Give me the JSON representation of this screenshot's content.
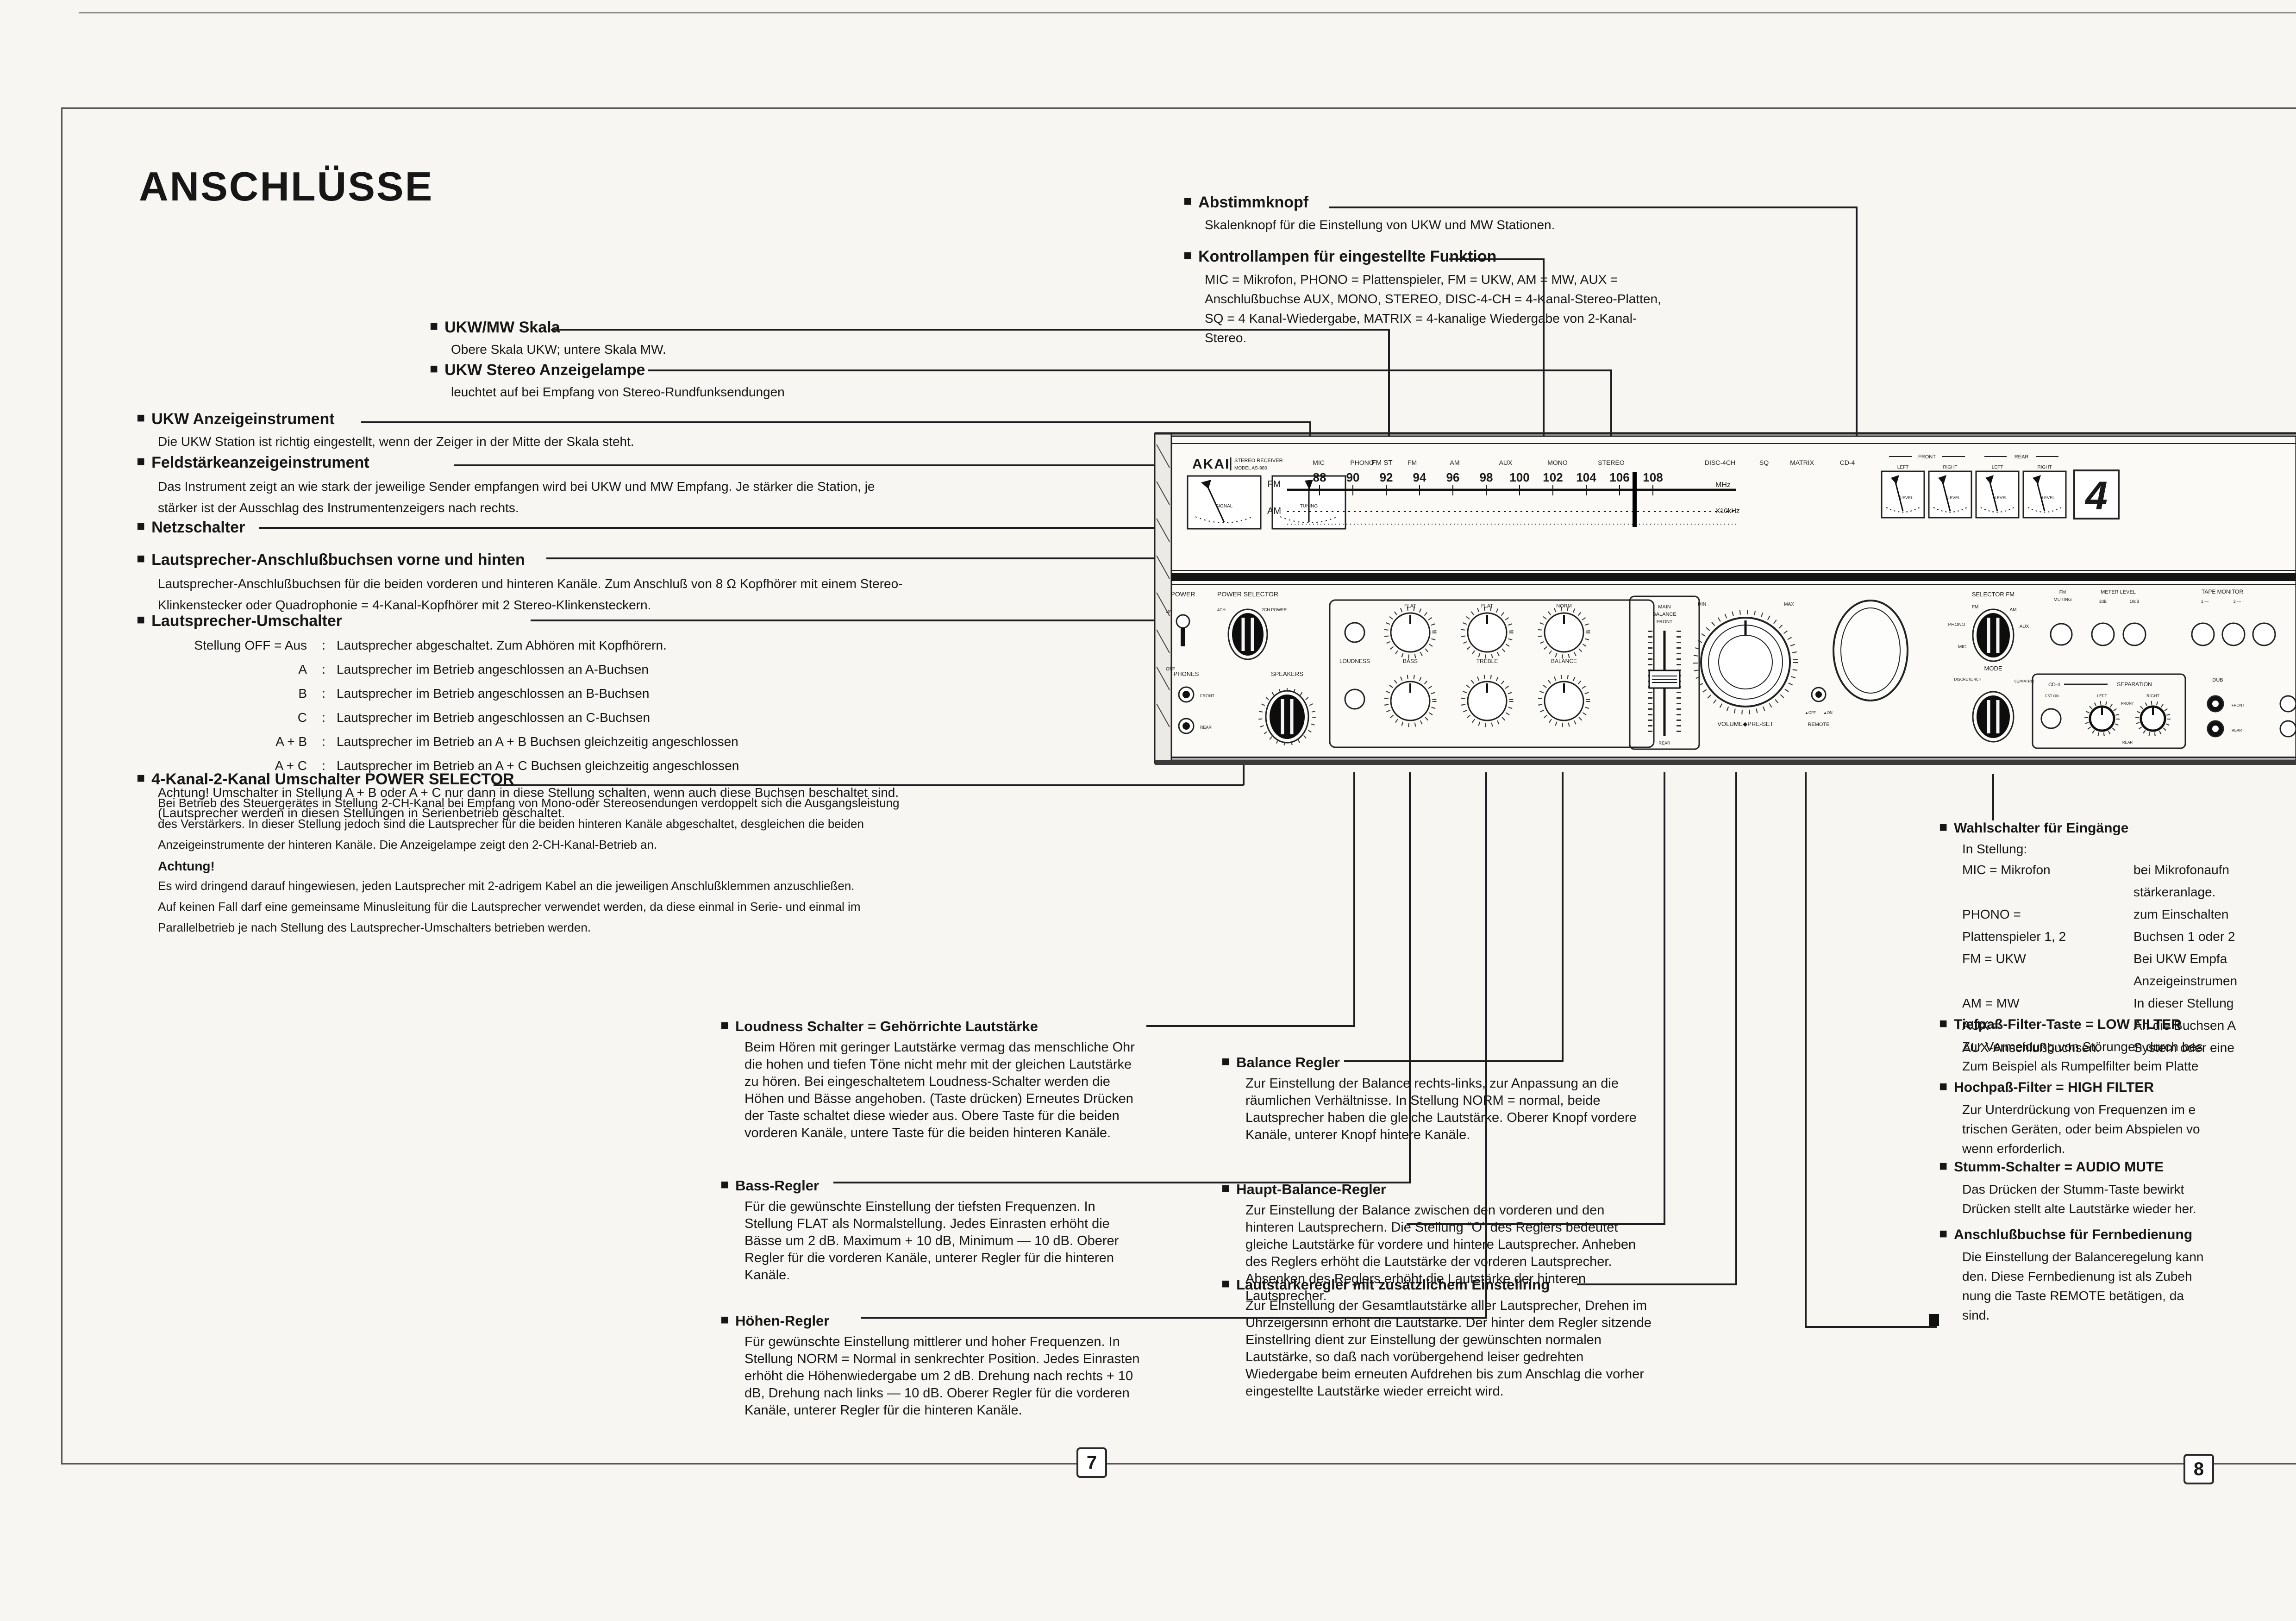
{
  "page": {
    "title": "ANSCHLÜSSE",
    "bullet": "■",
    "page_number_left": "7",
    "page_number_right": "8"
  },
  "annotations": {
    "abstimmknopf": {
      "heading": "Abstimmknopf",
      "body": "Skalenknopf für die Einstellung von UKW und MW Stationen."
    },
    "kontrollampen": {
      "heading": "Kontrollampen für eingestellte Funktion",
      "body": "MIC = Mikrofon, PHONO = Plattenspieler, FM = UKW, AM = MW, AUX = Anschlußbuchse AUX, MONO, STEREO, DISC-4-CH = 4-Kanal-Stereo-Platten, SQ = 4 Kanal-Wiedergabe, MATRIX = 4-kanalige Wiedergabe von 2-Kanal-Stereo."
    },
    "ukw_mw_skala": {
      "heading": "UKW/MW Skala",
      "body": "Obere Skala UKW; untere Skala MW."
    },
    "ukw_stereo_lampe": {
      "heading": "UKW Stereo Anzeigelampe",
      "body": "leuchtet auf bei Empfang von Stereo-Rundfunksendungen"
    },
    "ukw_anzeigeinstrument": {
      "heading": "UKW Anzeigeinstrument",
      "body": "Die UKW Station ist richtig eingestellt, wenn der Zeiger in der Mitte der Skala steht."
    },
    "feldstaerke": {
      "heading": "Feldstärkeanzeigeinstrument",
      "body": "Das Instrument zeigt an wie stark der jeweilige Sender empfangen wird bei UKW und MW Empfang. Je stärker die Station, je stärker ist der Ausschlag des Instrumentenzeigers nach rechts."
    },
    "netzschalter": {
      "heading": "Netzschalter"
    },
    "ls_buchsen": {
      "heading": "Lautsprecher-Anschlußbuchsen vorne und hinten",
      "body": "Lautsprecher-Anschlußbuchsen für die beiden vorderen und hinteren Kanäle. Zum Anschluß von 8 Ω Kopfhörer mit einem Stereo-Klinkenstecker oder Quadrophonie = 4-Kanal-Kopfhörer mit 2 Stereo-Klinkensteckern.",
      "rows": []
    },
    "ls_umschalter": {
      "heading": "Lautsprecher-Umschalter",
      "rows": [
        {
          "pos": "Stellung OFF = Aus",
          "colon": ":",
          "desc": "Lautsprecher abgeschaltet. Zum Abhören mit Kopfhörern."
        },
        {
          "pos": "A",
          "colon": ":",
          "desc": "Lautsprecher im Betrieb angeschlossen an A-Buchsen"
        },
        {
          "pos": "B",
          "colon": ":",
          "desc": "Lautsprecher im Betrieb angeschlossen an B-Buchsen"
        },
        {
          "pos": "C",
          "colon": ":",
          "desc": "Lautsprecher im Betrieb angeschlossen an C-Buchsen"
        },
        {
          "pos": "A + B",
          "colon": ":",
          "desc": "Lautsprecher im Betrieb an A + B Buchsen gleichzeitig angeschlossen"
        },
        {
          "pos": "A + C",
          "colon": ":",
          "desc": "Lautsprecher im Betrieb an A + C Buchsen gleichzeitig angeschlossen"
        }
      ],
      "note": "Achtung! Umschalter in Stellung A + B oder A + C nur dann in diese Stellung schalten, wenn auch diese Buchsen beschaltet sind. (Lautsprecher werden in diesen Stellungen in Serienbetrieb geschaltet."
    },
    "power_selector": {
      "heading": "4-Kanal-2-Kanal Umschalter POWER SELECTOR",
      "body1": "Bei Betrieb des Steuergerätes in Stellung 2-CH-Kanal bei Empfang von Mono-oder Stereosendungen verdoppelt sich die Ausgangsleistung des Verstärkers. In dieser Stellung jedoch sind die Lautsprecher für die beiden hinteren Kanäle abgeschaltet, desgleichen die beiden Anzeigeinstrumente der hinteren Kanäle. Die Anzeigelampe zeigt den 2-CH-Kanal-Betrieb an.",
      "subheading": "Achtung!",
      "body2": "Es wird dringend darauf hingewiesen, jeden Lautsprecher mit 2-adrigem Kabel an die jeweiligen Anschlußklemmen anzuschließen. Auf keinen Fall darf eine gemeinsame Minusleitung für die Lautsprecher verwendet werden, da diese einmal in Serie- und einmal im Parallelbetrieb je nach Stellung des Lautsprecher-Umschalters betrieben werden."
    },
    "loudness": {
      "heading": "Loudness Schalter = Gehörrichte Lautstärke",
      "body": "Beim Hören mit geringer Lautstärke vermag das menschliche Ohr die hohen und tiefen Töne nicht mehr mit der gleichen Lautstärke zu hören. Bei eingeschaltetem Loudness-Schalter werden die Höhen und Bässe angehoben. (Taste drücken) Erneutes Drücken der Taste schaltet diese wieder aus. Obere Taste für die beiden vorderen Kanäle, untere Taste für die beiden hinteren Kanäle."
    },
    "bass": {
      "heading": "Bass-Regler",
      "body": "Für die gewünschte Einstellung der tiefsten Frequenzen. In Stellung FLAT als Normalstellung. Jedes Einrasten erhöht die Bässe um 2 dB. Maximum + 10 dB, Minimum — 10 dB. Oberer Regler für die vorderen Kanäle, unterer Regler für die hinteren Kanäle."
    },
    "hoehen": {
      "heading": "Höhen-Regler",
      "body": "Für gewünschte Einstellung mittlerer und hoher Frequenzen. In Stellung NORM = Normal in senkrechter Position. Jedes Einrasten erhöht die Höhenwiedergabe um 2 dB. Drehung nach rechts + 10 dB, Drehung nach links — 10 dB. Oberer Regler für die vorderen Kanäle, unterer Regler für die hinteren Kanäle."
    },
    "balance": {
      "heading": "Balance Regler",
      "body": "Zur Einstellung der Balance rechts-links, zur Anpassung an die räumlichen Verhältnisse. In Stellung NORM = normal, beide Lautsprecher haben die gleiche Lautstärke. Oberer Knopf vordere Kanäle, unterer Knopf hintere Kanäle."
    },
    "haupt_balance": {
      "heading": "Haupt-Balance-Regler",
      "body": "Zur Einstellung der Balance zwischen den vorderen und den hinteren Lautsprechern. Die Stellung “O” des Reglers bedeutet gleiche Lautstärke für vordere und hintere Lautsprecher. Anheben des Reglers erhöht die Lautstärke der vorderen Lautsprecher. Absenken des Reglers erhöht die Lautstärke der hinteren Lautsprecher."
    },
    "lautstaerke": {
      "heading": "Lautstärkeregler mit zusätzlichem Einstellring",
      "body": "Zur Einstellung der Gesamtlautstärke aller Lautsprecher, Drehen im Uhrzeigersinn erhöht die Lautstärke. Der hinter dem Regler sitzende Einstellring dient zur Einstellung der gewünschten normalen Lautstärke, so daß nach vorübergehend leiser gedrehten Wiedergabe beim erneuten Aufdrehen bis zum Anschlag die vorher eingestellte Lautstärke wieder erreicht wird."
    },
    "wahlschalter": {
      "heading": "Wahlschalter für Eingänge",
      "intro": "In Stellung:",
      "rows": [
        {
          "left": "MIC = Mikrofon",
          "right": "bei Mikrofonaufn"
        },
        {
          "left": "",
          "right": "stärkeranlage."
        },
        {
          "left": "PHONO =",
          "right": "zum Einschalten"
        },
        {
          "left": "Plattenspieler 1, 2",
          "right": "Buchsen 1 oder 2"
        },
        {
          "left": "FM = UKW",
          "right": "Bei UKW Empfa"
        },
        {
          "left": "",
          "right": "Anzeigeinstrumen"
        },
        {
          "left": "AM = MW",
          "right": "In dieser Stellung"
        },
        {
          "left": "AUX =",
          "right": "An die Buchsen A"
        },
        {
          "left": "AUX-Anschlußbuchsen.",
          "right": "System oder eine"
        }
      ]
    },
    "tiefpass": {
      "heading": "Tiefpaß-Filter-Taste = LOW FILTER",
      "lines": [
        "Zur Vermeidung von Störungen durch bes",
        "Zum Beispiel als Rumpelfilter beim Platte"
      ]
    },
    "hochpass": {
      "heading": "Hochpaß-Filter = HIGH FILTER",
      "lines": [
        "Zur Unterdrückung von Frequenzen im e",
        "trischen Geräten, oder beim Abspielen vo",
        "wenn erforderlich."
      ]
    },
    "stumm": {
      "heading": "Stumm-Schalter = AUDIO MUTE",
      "lines": [
        "Das Drücken der Stumm-Taste bewirkt",
        "Drücken stellt alte Lautstärke wieder her."
      ]
    },
    "fernbedienung": {
      "heading": "Anschlußbuchse für Fernbedienung",
      "lines": [
        "Die Einstellung der Balanceregelung kann",
        "den. Diese Fernbedienung ist als Zubeh",
        "nung die Taste REMOTE betätigen, da",
        "sind."
      ]
    }
  },
  "panel": {
    "brand": "AKAI",
    "brand_type": "STEREO RECEIVER",
    "brand_model": "MODEL AS-980",
    "meter_signal": "SIGNAL",
    "meter_tuning": "TUNING",
    "fm_stereo": "FM ST",
    "lamps": [
      "MIC",
      "PHONO",
      "FM",
      "AM",
      "AUX",
      "MONO",
      "STEREO",
      "DISC-4CH",
      "SQ",
      "MATRIX"
    ],
    "lamp_cd4": "CD-4",
    "dial_fm": "FM",
    "dial_am": "AM",
    "mhz": "MHz",
    "x10khz": "X10kHz",
    "fm_numbers": [
      "88",
      "90",
      "92",
      "94",
      "96",
      "98",
      "100",
      "102",
      "104",
      "106",
      "108"
    ],
    "front": "FRONT",
    "rear": "REAR",
    "left": "LEFT",
    "right": "RIGHT",
    "level": "LEVEL",
    "badge": "4",
    "power": "POWER",
    "power_on": "ON",
    "power_off": "OFF",
    "power_selector": "POWER SELECTOR",
    "ps_4ch": "4CH",
    "ps_2ch": "2CH POWER",
    "phones": "PHONES",
    "speakers": "SPEAKERS",
    "loudness": "LOUDNESS",
    "bass": "BASS",
    "treble": "TREBLE",
    "balance": "BALANCE",
    "flat": "FLAT",
    "norm": "NORM",
    "main_balance_1": "MAIN",
    "main_balance_2": "BALANCE",
    "volume_label": "VOLUME◆PRE-SET",
    "min": "MIN",
    "max": "MAX",
    "remote": "REMOTE",
    "remote_off": "▲OFF",
    "remote_on": "▲ON",
    "selector_fm": "SELECTOR FM",
    "sel_fm": "FM",
    "sel_am": "AM",
    "sel_aux": "AUX",
    "sel_phono": "PHONO",
    "sel_mic": "MIC",
    "fm_muting_1": "FM",
    "fm_muting_2": "MUTING",
    "meter_level": "METER LEVEL",
    "db2": "2dB",
    "db10": "10dB",
    "tape_monitor": "TAPE MONITOR",
    "tm1": "1 —",
    "tm2": "2 —",
    "mode": "MODE",
    "mode_discrete": "DISCRETE 4CH",
    "mode_sq": "SQ/MATRIX",
    "cd4": "CD-4",
    "separation": "SEPARATION",
    "fst_on": "FST ON",
    "dub": "DUB"
  }
}
